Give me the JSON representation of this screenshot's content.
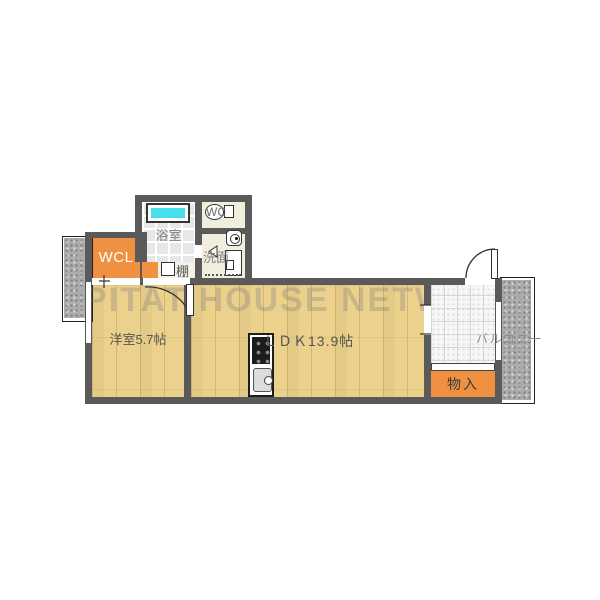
{
  "watermark": {
    "text": "PITAT HOUSE NETWORK"
  },
  "rooms": {
    "bathroom": {
      "label": "浴室"
    },
    "toilet": {
      "label": "WC"
    },
    "washroom": {
      "label": "洗面"
    },
    "walk_in_closet": {
      "label": "WCL"
    },
    "shelf": {
      "label": "棚"
    },
    "western_room": {
      "label": "洋室5.7帖"
    },
    "ldk": {
      "label": "ＬＤＫ13.9帖"
    },
    "storage": {
      "label": "物入"
    },
    "balcony": {
      "label": "バルコニー"
    }
  },
  "colors": {
    "wall": "#5a5a5a",
    "wood_floor": "#ecd18c",
    "closet_orange": "#ef9140",
    "service_floor": "#f1eedd",
    "bath_floor": "#e7e7e7",
    "bathtub_water": "#45dfee",
    "balcony_gray": "#acacac",
    "watermark_gray": "#808080"
  }
}
